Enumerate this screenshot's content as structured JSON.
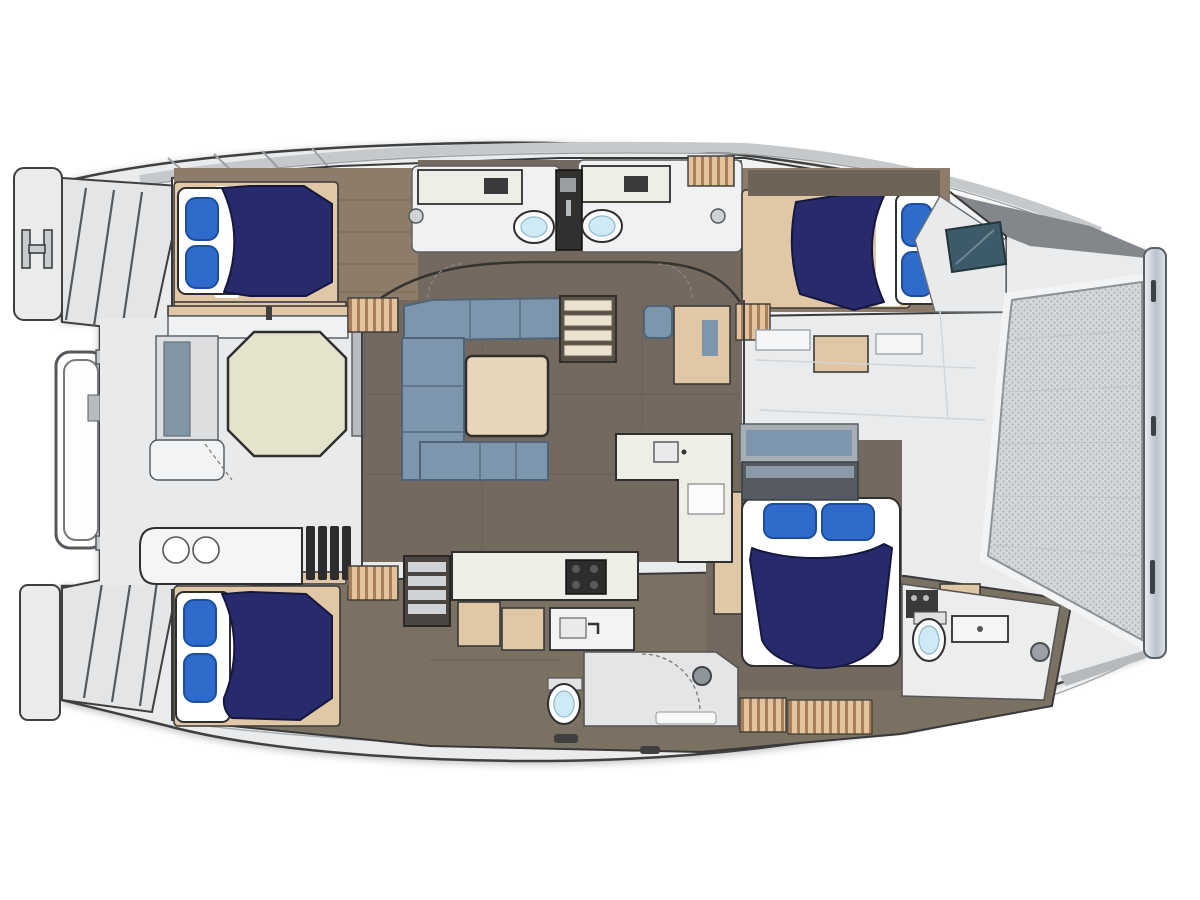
{
  "diagram": {
    "subject": "catamaran-interior-deck-plan",
    "bow_side": "right",
    "stern_side": "left"
  },
  "colors": {
    "background": "#ffffff",
    "outline": "#3f3f3f",
    "deck": "#e9ebec",
    "deck_band": "#c6c9cb",
    "salon_floor": "#74695e",
    "hull_floor": "#7b7163",
    "wood_floor": "#8c7c69",
    "plank_line": "#766755",
    "wood_trim": "#e0c7a6",
    "locker_slat": "#e3c29e",
    "locker_slat_dark": "#a87f58",
    "bed_navy": "#282b6b",
    "bed_navy_edge": "#15173f",
    "pillow_blue": "#2f6bca",
    "pillow_edge": "#1c4d9f",
    "mattress": "#ffffff",
    "sofa_blue": "#7e96ad",
    "sofa_edge": "#4e6478",
    "salon_table": "#e8d6ba",
    "cockpit_table": "#e6e3cc",
    "counter_cream": "#efeee6",
    "fixture_white": "#f7f8f9",
    "basin_blue": "#cfe9f5",
    "hatch_teal": "#3d5a68",
    "tramp_base": "#d6d8da",
    "tramp_dot": "#aeb3b6",
    "beam_light": "#eef1f3",
    "beam_mid": "#b9c3cc",
    "dark_fixture": "#2e2d2c",
    "bench_gray": "#dcdee0",
    "headboard_gray": "#565b61"
  }
}
